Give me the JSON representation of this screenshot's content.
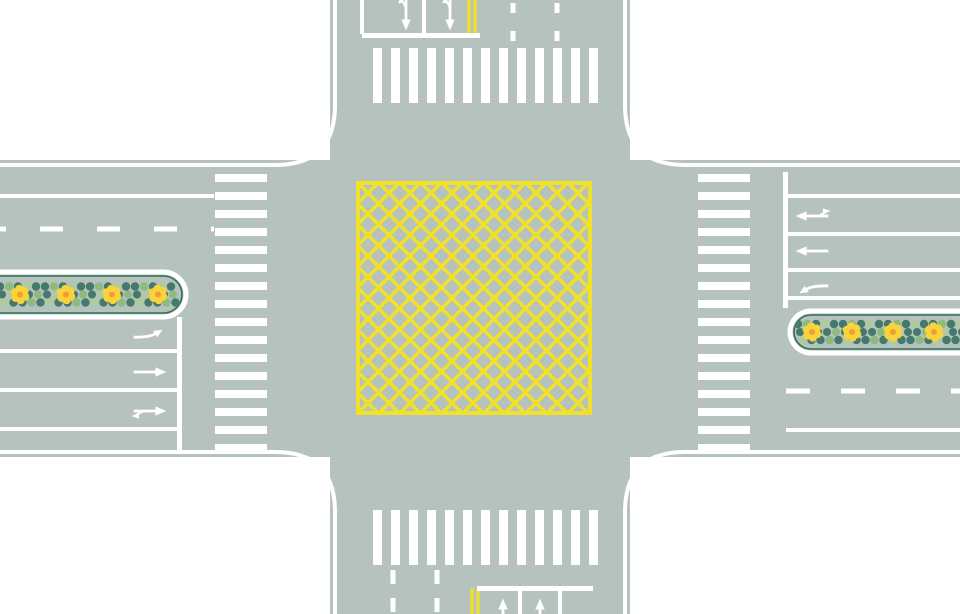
{
  "meta": {
    "description": "top-down road intersection diagram with yellow box-junction grid, zebra crosswalks, lane arrows and planted median strips"
  },
  "canvas": {
    "width": 960,
    "height": 614,
    "background": "#ffffff"
  },
  "colors": {
    "road": "#b6c2bd",
    "marking_white": "#ffffff",
    "marking_yellow": "#f1e229",
    "median_inner_border": "#2f7158",
    "dot_dark": "#44796b",
    "dot_light": "#8fba7f",
    "dot_pale": "#aecb9e",
    "flower_petal": "#f8d33c",
    "flower_center": "#ef9d35"
  },
  "road": {
    "h_band": {
      "y": 160,
      "h": 297
    },
    "v_band": {
      "x": 330,
      "w": 300
    },
    "fillet_radius": 55,
    "curb_line_offset": 5,
    "curb_line_width": 4
  },
  "box_junction": {
    "x": 358,
    "y": 183,
    "w": 232,
    "h": 230,
    "line_spacing": 21,
    "line_width": 3.5,
    "border_width": 4
  },
  "crosswalks": [
    {
      "id": "north",
      "orientation": "vertical-stripes",
      "x": 373,
      "y": 48,
      "stripe_w": 9,
      "stripe_h": 55,
      "gap": 9,
      "count": 13
    },
    {
      "id": "south",
      "orientation": "vertical-stripes",
      "x": 373,
      "y": 510,
      "stripe_w": 9,
      "stripe_h": 55,
      "gap": 9,
      "count": 13
    },
    {
      "id": "west",
      "orientation": "horizontal-stripes",
      "x": 215,
      "y": 174,
      "stripe_w": 52,
      "stripe_h": 8,
      "gap": 10,
      "count": 16
    },
    {
      "id": "east",
      "orientation": "horizontal-stripes",
      "x": 698,
      "y": 174,
      "stripe_w": 52,
      "stripe_h": 8,
      "gap": 10,
      "count": 16
    }
  ],
  "stop_lines": [
    {
      "id": "north",
      "x": 362,
      "y": 33,
      "w": 118,
      "h": 5
    },
    {
      "id": "south",
      "x": 477,
      "y": 586,
      "w": 116,
      "h": 5
    },
    {
      "id": "west",
      "x": 177,
      "y": 317,
      "w": 5,
      "h": 135
    },
    {
      "id": "east",
      "x": 783,
      "y": 172,
      "w": 5,
      "h": 136
    }
  ],
  "lane_lines": [
    {
      "id": "west-exit-edge",
      "x1": 0,
      "y1": 196,
      "x2": 214,
      "y2": 196,
      "w": 4,
      "style": "solid",
      "color": "white"
    },
    {
      "id": "west-exit-divider",
      "x1": 0,
      "y1": 229,
      "x2": 214,
      "y2": 229,
      "w": 5,
      "style": "dashed",
      "dash": [
        23,
        34
      ],
      "dashoffset": 17,
      "color": "white"
    },
    {
      "id": "west-approach-1",
      "x1": 0,
      "y1": 351,
      "x2": 178,
      "y2": 351,
      "w": 4,
      "style": "solid",
      "color": "white"
    },
    {
      "id": "west-approach-2",
      "x1": 0,
      "y1": 390,
      "x2": 178,
      "y2": 390,
      "w": 4,
      "style": "solid",
      "color": "white"
    },
    {
      "id": "west-approach-3",
      "x1": 0,
      "y1": 429,
      "x2": 178,
      "y2": 429,
      "w": 4,
      "style": "solid",
      "color": "white"
    },
    {
      "id": "east-approach-1",
      "x1": 788,
      "y1": 196,
      "x2": 960,
      "y2": 196,
      "w": 4,
      "style": "solid",
      "color": "white"
    },
    {
      "id": "east-approach-2",
      "x1": 788,
      "y1": 234,
      "x2": 960,
      "y2": 234,
      "w": 4,
      "style": "solid",
      "color": "white"
    },
    {
      "id": "east-approach-3",
      "x1": 788,
      "y1": 270,
      "x2": 960,
      "y2": 270,
      "w": 4,
      "style": "solid",
      "color": "white"
    },
    {
      "id": "east-approach-4",
      "x1": 788,
      "y1": 298,
      "x2": 960,
      "y2": 298,
      "w": 4,
      "style": "solid",
      "color": "white"
    },
    {
      "id": "east-exit-divider",
      "x1": 786,
      "y1": 391,
      "x2": 960,
      "y2": 391,
      "w": 5,
      "style": "dashed",
      "dash": [
        24,
        31
      ],
      "color": "white"
    },
    {
      "id": "east-exit-edge",
      "x1": 786,
      "y1": 430,
      "x2": 960,
      "y2": 430,
      "w": 4,
      "style": "solid",
      "color": "white"
    },
    {
      "id": "north-approach-1",
      "x1": 362,
      "y1": 0,
      "x2": 362,
      "y2": 34,
      "w": 4,
      "style": "solid",
      "color": "white"
    },
    {
      "id": "north-approach-2",
      "x1": 424,
      "y1": 0,
      "x2": 424,
      "y2": 34,
      "w": 4,
      "style": "solid",
      "color": "white"
    },
    {
      "id": "north-center-yellow-1",
      "x1": 469,
      "y1": 0,
      "x2": 469,
      "y2": 37,
      "w": 3.2,
      "style": "solid",
      "color": "yellow"
    },
    {
      "id": "north-center-yellow-2",
      "x1": 475,
      "y1": 0,
      "x2": 475,
      "y2": 37,
      "w": 3.2,
      "style": "solid",
      "color": "yellow"
    },
    {
      "id": "north-exit-divider-1",
      "x1": 513,
      "y1": 0,
      "x2": 513,
      "y2": 46,
      "w": 5,
      "style": "dashed",
      "dash": [
        10,
        18
      ],
      "dashoffset": 25,
      "color": "white"
    },
    {
      "id": "north-exit-divider-2",
      "x1": 557,
      "y1": 0,
      "x2": 557,
      "y2": 46,
      "w": 5,
      "style": "dashed",
      "dash": [
        10,
        18
      ],
      "dashoffset": 25,
      "color": "white"
    },
    {
      "id": "south-exit-divider-1",
      "x1": 393,
      "y1": 566,
      "x2": 393,
      "y2": 614,
      "w": 5,
      "style": "dashed",
      "dash": [
        14,
        14
      ],
      "dashoffset": 24,
      "color": "white"
    },
    {
      "id": "south-exit-divider-2",
      "x1": 437,
      "y1": 566,
      "x2": 437,
      "y2": 614,
      "w": 5,
      "style": "dashed",
      "dash": [
        14,
        14
      ],
      "dashoffset": 24,
      "color": "white"
    },
    {
      "id": "south-center-yellow-1",
      "x1": 472,
      "y1": 588,
      "x2": 472,
      "y2": 614,
      "w": 3.2,
      "style": "solid",
      "color": "yellow"
    },
    {
      "id": "south-center-yellow-2",
      "x1": 478,
      "y1": 588,
      "x2": 478,
      "y2": 614,
      "w": 3.2,
      "style": "solid",
      "color": "yellow"
    },
    {
      "id": "south-approach-1",
      "x1": 520,
      "y1": 591,
      "x2": 520,
      "y2": 614,
      "w": 4,
      "style": "solid",
      "color": "white"
    },
    {
      "id": "south-approach-2",
      "x1": 560,
      "y1": 591,
      "x2": 560,
      "y2": 614,
      "w": 4,
      "style": "solid",
      "color": "white"
    }
  ],
  "lane_arrows": [
    {
      "id": "north-lane-1",
      "type": "straight-uturn",
      "x": 406,
      "y": 14,
      "rot": 90
    },
    {
      "id": "north-lane-2",
      "type": "straight-uturn",
      "x": 450,
      "y": 14,
      "rot": 90
    },
    {
      "id": "west-lane-1",
      "type": "left-turn",
      "x": 150,
      "y": 336,
      "rot": 0
    },
    {
      "id": "west-lane-2",
      "type": "straight",
      "x": 150,
      "y": 372,
      "rot": 0
    },
    {
      "id": "west-lane-3",
      "type": "straight-uturn",
      "x": 150,
      "y": 411,
      "rot": 0
    },
    {
      "id": "east-lane-1",
      "type": "straight-uturn",
      "x": 812,
      "y": 216,
      "rot": 180
    },
    {
      "id": "east-lane-2",
      "type": "straight",
      "x": 812,
      "y": 251,
      "rot": 180
    },
    {
      "id": "east-lane-3",
      "type": "left-turn",
      "x": 812,
      "y": 287,
      "rot": 180
    },
    {
      "id": "south-lane-1",
      "type": "straight",
      "x": 503,
      "y": 615,
      "rot": 270
    },
    {
      "id": "south-lane-2",
      "type": "straight",
      "x": 540,
      "y": 615,
      "rot": 270
    }
  ],
  "medians": [
    {
      "id": "west",
      "x": -30,
      "y": 272,
      "w": 216,
      "h": 45,
      "dots_x0": 0,
      "dots_x1": 178,
      "cy": 294.5,
      "flower_xs": [
        20,
        66,
        112,
        158
      ]
    },
    {
      "id": "east",
      "x": 790,
      "y": 311,
      "w": 205,
      "h": 42,
      "dots_x0": 798,
      "dots_x1": 960,
      "cy": 332,
      "flower_xs": [
        812,
        852,
        893,
        934
      ]
    }
  ]
}
